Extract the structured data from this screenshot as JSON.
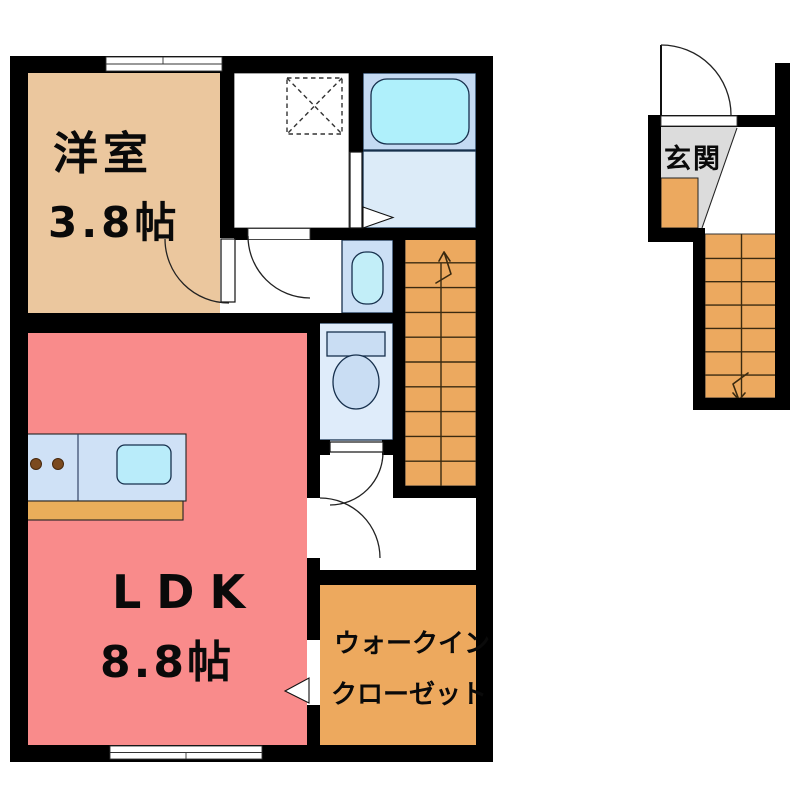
{
  "plan": {
    "title": "apartment-floor-plan",
    "rooms": {
      "western_room": {
        "name": "洋室",
        "size": "3.8帖"
      },
      "ldk": {
        "name": "LDK",
        "size": "8.8帖"
      },
      "walk_in_closet": {
        "name_line1": "ウォークイン",
        "name_line2": "クローゼット"
      },
      "entrance": {
        "name": "玄関"
      }
    },
    "fixtures": [
      "bathtub",
      "washing-machine-pan",
      "washbasin",
      "toilet",
      "kitchen-counter",
      "staircase-up",
      "staircase-down",
      "entry-door",
      "windows"
    ],
    "palette": {
      "wall": "#000000",
      "yoshitsu_floor": "#ebc79e",
      "ldk_floor": "#f98b8b",
      "closet_orange": "#eda95e",
      "stair_orange": "#eca95f",
      "counter_base": "#e9ae5a",
      "genkan_gray": "#dcdcdc",
      "bath_zone": "#c4daf2",
      "bathtub": "#aff0fb",
      "washroom": "#dcebf8",
      "sink_room": "#cbdff5",
      "basin": "#c2eef8",
      "toilet_room": "#dfecfa",
      "toilet_fixture": "#c9ddf3",
      "counter_blue": "#cfe1f6",
      "counter_sink": "#b9ecfa",
      "white": "#ffffff"
    }
  }
}
